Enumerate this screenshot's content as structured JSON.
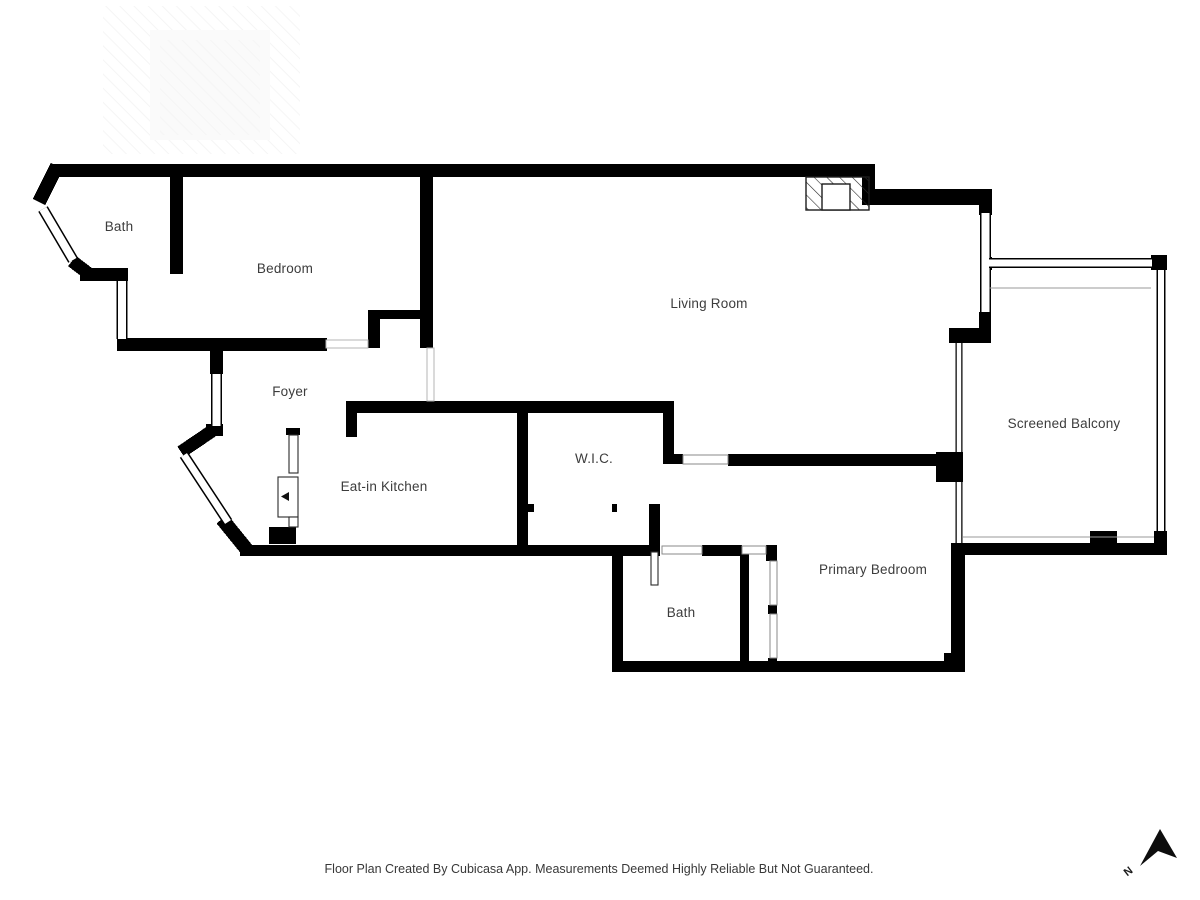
{
  "rooms": {
    "bath_top": "Bath",
    "bedroom": "Bedroom",
    "living_room": "Living Room",
    "foyer": "Foyer",
    "kitchen": "Eat-in Kitchen",
    "wic": "W.I.C.",
    "bath_lower": "Bath",
    "primary_bedroom": "Primary Bedroom",
    "balcony": "Screened Balcony"
  },
  "footer": {
    "disclaimer": "Floor Plan Created By Cubicasa App. Measurements Deemed Highly Reliable But Not Guaranteed."
  },
  "compass": {
    "north_label": "N"
  },
  "colors": {
    "wall": "#000000",
    "label_text": "#3c3c3c",
    "threshold": "#8a8a8a",
    "background": "#ffffff"
  }
}
